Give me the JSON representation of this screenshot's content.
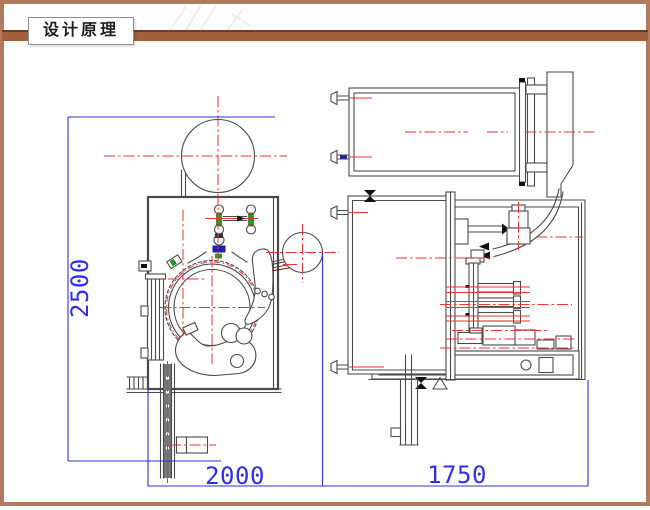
{
  "header": {
    "title": "设计原理"
  },
  "dimensions": {
    "height_left": "2500",
    "width_left": "2000",
    "width_right": "1750"
  },
  "colors": {
    "frame_brown": "#b1795d",
    "bar_brown": "#a2613a",
    "bar_brown_dark": "#6b3c20",
    "dim_blue": "#2f2fe8",
    "centerline_red": "#f03333",
    "part_gray": "#4a4a4a",
    "accent_green": "#19a21f",
    "accent_navy": "#2121a8",
    "accent_teal": "#2e6b6b",
    "accent_darkred": "#7c1212",
    "valve_black": "#111111"
  }
}
